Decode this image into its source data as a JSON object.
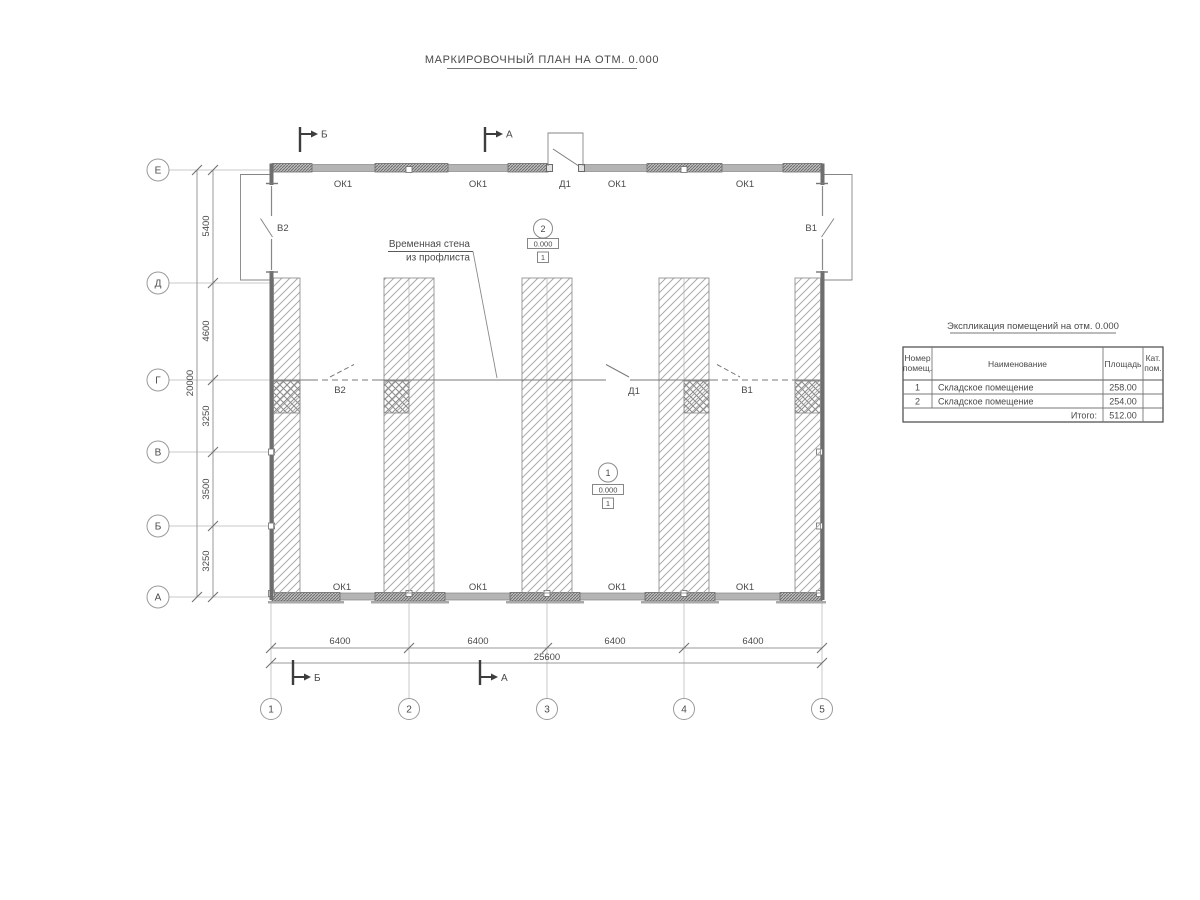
{
  "title": "МАРКИРОВОЧНЫЙ ПЛАН НА ОТМ. 0.000",
  "axes": {
    "rows": [
      "Е",
      "Д",
      "Г",
      "В",
      "Б",
      "А"
    ],
    "cols": [
      "1",
      "2",
      "3",
      "4",
      "5"
    ]
  },
  "dimensions": {
    "left_segments": [
      "5400",
      "4600",
      "3250",
      "3500",
      "3250"
    ],
    "left_total": "20000",
    "bottom_segments": [
      "6400",
      "6400",
      "6400",
      "6400"
    ],
    "bottom_total": "25600"
  },
  "openings": {
    "windows_top": [
      "ОК1",
      "ОК1",
      "ОК1",
      "ОК1"
    ],
    "windows_bottom": [
      "ОК1",
      "ОК1",
      "ОК1",
      "ОК1"
    ],
    "door_top": "Д1",
    "gate_left": "В2",
    "gate_right": "В1",
    "partition_doors": [
      "В2",
      "Д1",
      "В1"
    ]
  },
  "annotation": {
    "line1": "Временная стена",
    "line2": "из профлиста"
  },
  "markers": {
    "room1": {
      "number": "1",
      "elevation": "0.000",
      "floor": "1"
    },
    "room2": {
      "number": "2",
      "elevation": "0.000",
      "floor": "1"
    }
  },
  "sections": {
    "top_b": "Б",
    "top_a": "А",
    "bottom_b": "Б",
    "bottom_a": "А"
  },
  "table": {
    "title": "Экспликация помещений на отм. 0.000",
    "headers": {
      "number_l1": "Номер",
      "number_l2": "помещ.",
      "name": "Наименование",
      "area": "Площадь",
      "cat_l1": "Кат.",
      "cat_l2": "пом."
    },
    "rows": [
      {
        "num": "1",
        "name": "Складское помещение",
        "area": "258.00",
        "cat": ""
      },
      {
        "num": "2",
        "name": "Складское помещение",
        "area": "254.00",
        "cat": ""
      }
    ],
    "total_label": "Итого:",
    "total_value": "512.00"
  },
  "colors": {
    "ink": "#4a4a4a",
    "line": "#9a9a9a",
    "wall_fill": "#b4b4b4",
    "wall_dark": "#6e6e6e"
  }
}
